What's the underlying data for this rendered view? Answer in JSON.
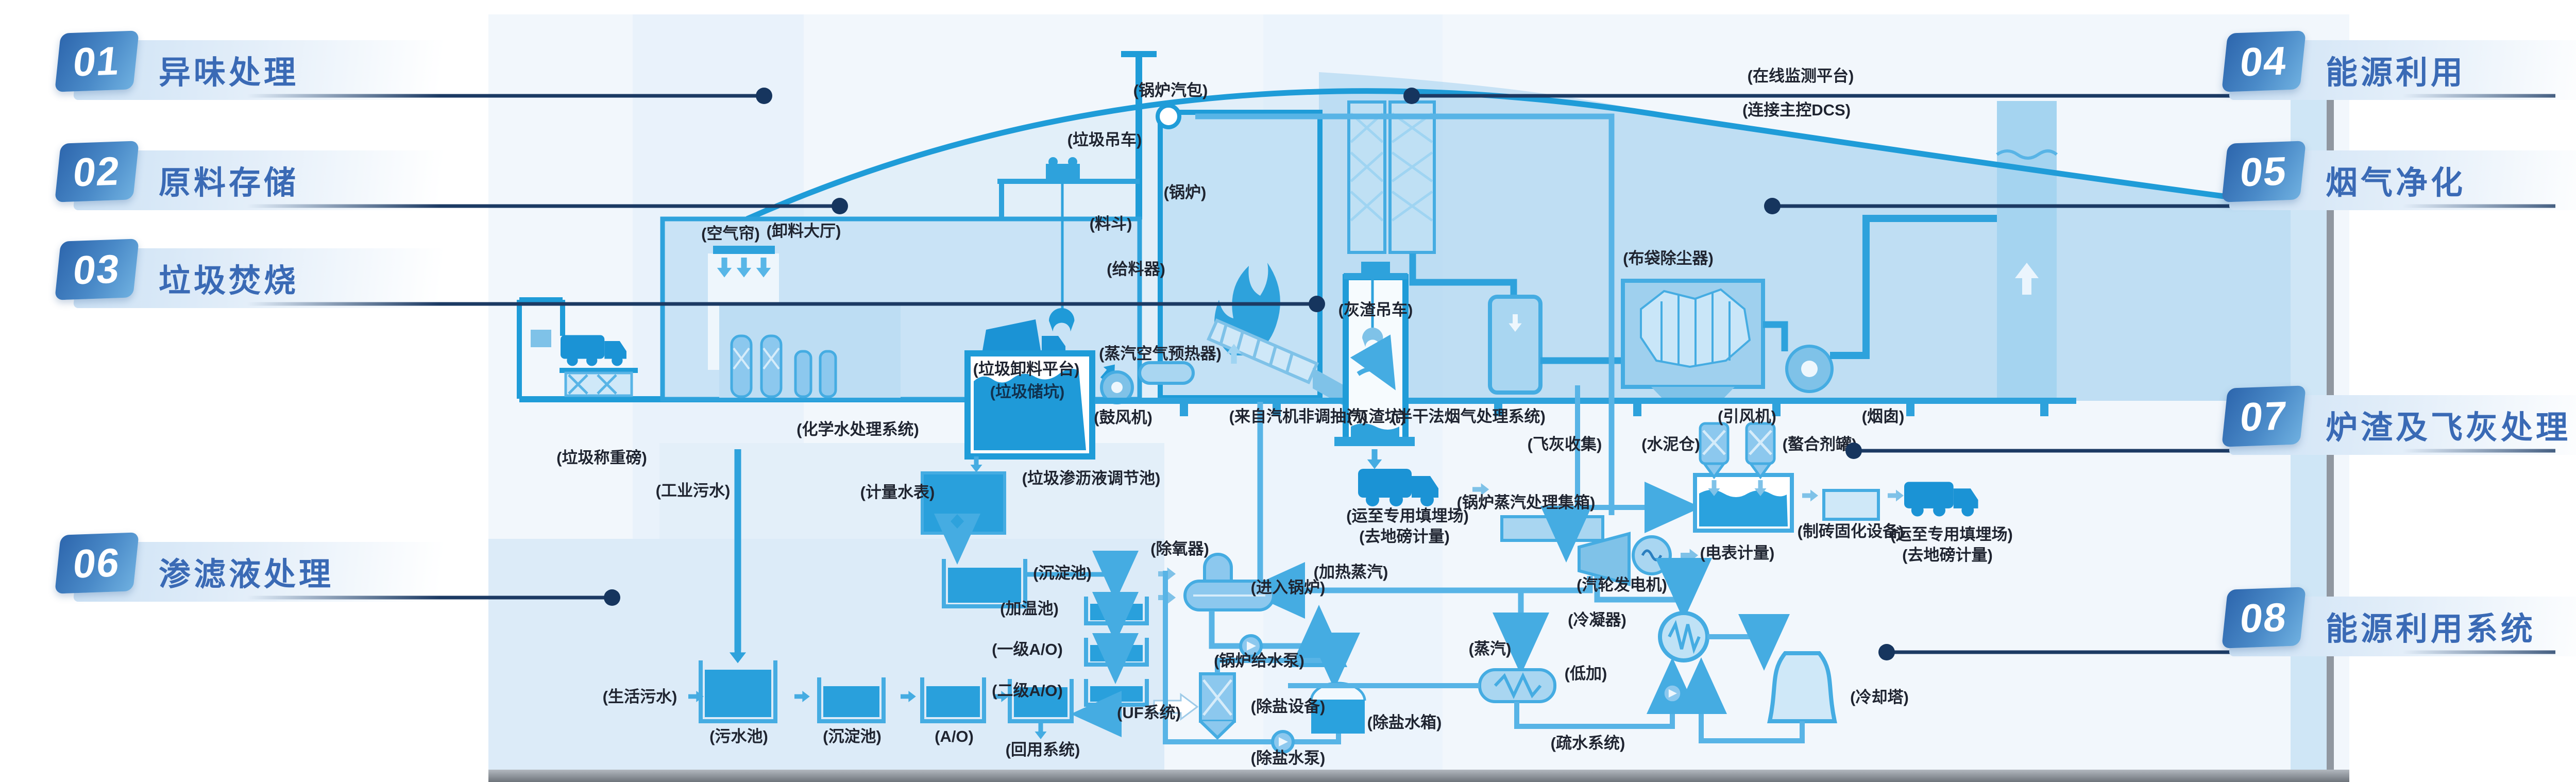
{
  "legend": {
    "left": [
      {
        "num": "01",
        "title": "异味处理"
      },
      {
        "num": "02",
        "title": "原料存储"
      },
      {
        "num": "03",
        "title": "垃圾焚烧"
      },
      {
        "num": "06",
        "title": "渗滤液处理"
      }
    ],
    "right": [
      {
        "num": "04",
        "title": "能源利用"
      },
      {
        "num": "05",
        "title": "烟气净化"
      },
      {
        "num": "07",
        "title": "炉渣及飞灰处理"
      },
      {
        "num": "08",
        "title": "能源利用系统"
      }
    ]
  },
  "diagram": {
    "labels": {
      "boiler_drum": "(锅炉汽包)",
      "waste_crane": "(垃圾吊车)",
      "hopper": "(料斗)",
      "online_platform": "(在线监测平台)",
      "dcs": "(连接主控DCS)",
      "air_curtain": "(空气帘)",
      "unloading_hall": "(卸料大厅)",
      "unloading_platform": "(垃圾卸料平台)",
      "feeder": "(给料器)",
      "boiler": "(锅炉)",
      "weighbridge": "(垃圾称重磅)",
      "chem_water": "(化学水处理系统)",
      "waste_bunker": "(垃圾储坑)",
      "steam_air_preheater": "(蒸汽空气预热器)",
      "fd_fan": "(鼓风机)",
      "turbine_extraction": "(来自汽机非调抽汽)",
      "slag_crane": "(灰渣吊车)",
      "slag_pit": "(灰渣坑)",
      "semi_dry": "(半干法烟气处理系统)",
      "bag_filter": "(布袋除尘器)",
      "id_fan": "(引风机)",
      "chimney": "(烟囱)",
      "cement_silo": "(水泥仓)",
      "chelating_tank": "(螯合剂罐)",
      "fly_ash": "(飞灰收集)",
      "landfill1": "(运至专用填埋场)",
      "landfill1b": "(去地磅计量)",
      "brick_equipment": "(制砖固化设备)",
      "landfill2": "(运至专用填埋场)",
      "landfill2b": "(去地磅计量)",
      "steam_header": "(锅炉蒸汽处理集箱)",
      "turbo_generator": "(汽轮发电机)",
      "meter": "(电表计量)",
      "condenser": "(冷凝器)",
      "steam": "(蒸汽)",
      "lp_heater": "(低加)",
      "drain_system": "(疏水系统)",
      "cooling_tower": "(冷却塔)",
      "deaerator": "(除氧器)",
      "heating_steam": "(加热蒸汽)",
      "to_boiler": "(进入锅炉)",
      "feed_pump": "(锅炉给水泵)",
      "demin_equipment": "(除盐设备)",
      "demin_tank": "(除盐水箱)",
      "demin_pump": "(除盐水泵)",
      "industrial_sewage": "(工业污水)",
      "leachate_pool": "(垃圾渗沥液调节池)",
      "water_meter": "(计量水表)",
      "sediment_pool1": "(沉淀池)",
      "heating_pool": "(加温池)",
      "ao1": "(一级A/O)",
      "ao2": "(二级A/O)",
      "uf": "(UF系统)",
      "domestic_sewage": "(生活污水)",
      "sewage_pool": "(污水池)",
      "sediment_pool2": "(沉淀池)",
      "ao": "(A/O)",
      "reuse": "(回用系统)"
    }
  },
  "colors": {
    "accent_navy": "#1c3a63",
    "legend_blue": "#3a6ab5",
    "number_box_dark": "#2d66ad",
    "number_box_light": "#6fb0e0",
    "pipe_blue": "#45ace2",
    "structure_blue": "#2ea2dc",
    "fill_dark": "#1f9ad8",
    "fill_mid": "#8cc8ee",
    "fill_light": "#c9e3f6",
    "panel_blue": "#dcebf8",
    "ground_gray": "#70767d"
  }
}
